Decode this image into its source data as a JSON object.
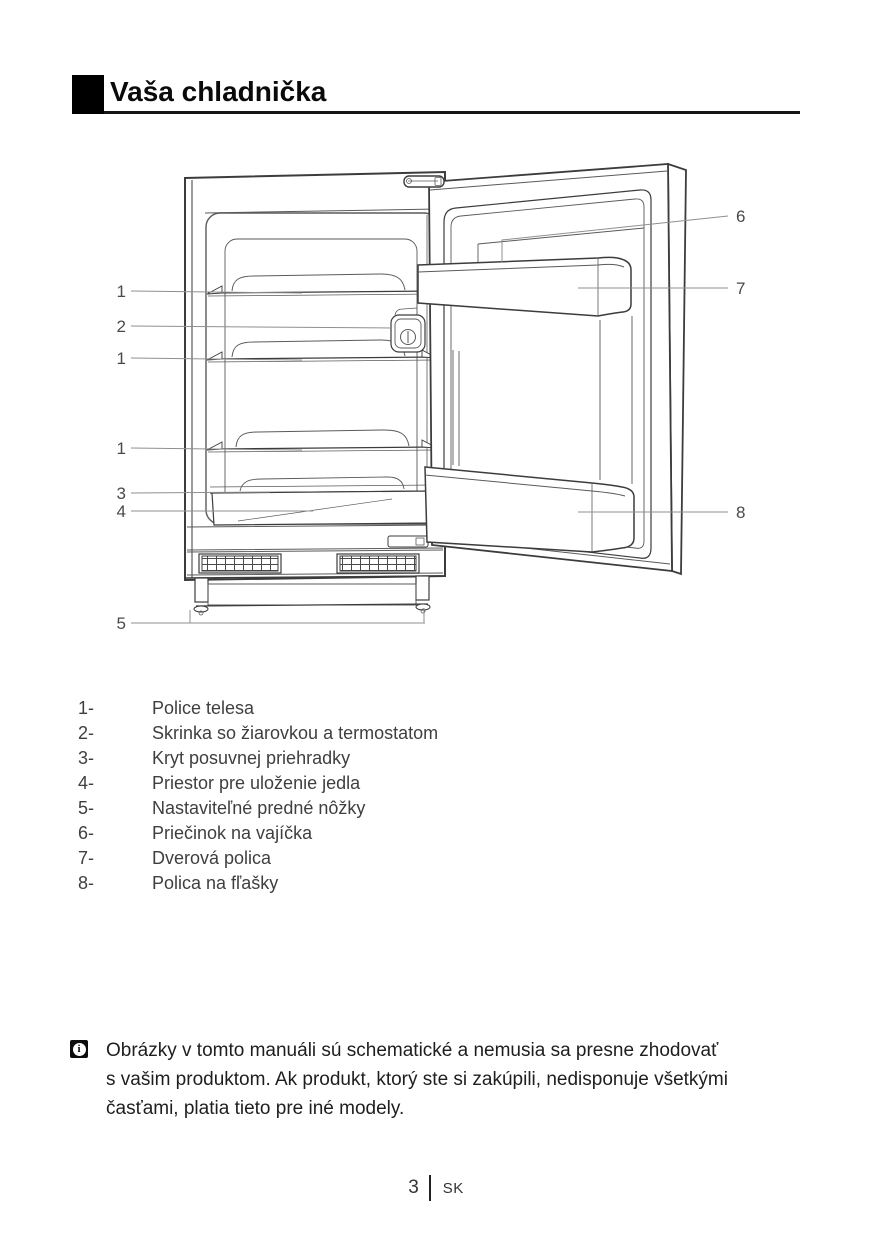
{
  "page": {
    "title": "Vaša chladnička",
    "page_number": "3",
    "language_code": "SK"
  },
  "diagram": {
    "description": "open refrigerator line drawing with numbered callouts",
    "callouts_left": [
      {
        "label": "1"
      },
      {
        "label": "2"
      },
      {
        "label": "1"
      },
      {
        "label": "1"
      },
      {
        "label": "3"
      },
      {
        "label": "4"
      },
      {
        "label": "5"
      }
    ],
    "callouts_right": [
      {
        "label": "6"
      },
      {
        "label": "7"
      },
      {
        "label": "8"
      }
    ]
  },
  "parts": {
    "items": [
      {
        "num": "1-",
        "name": "Police telesa"
      },
      {
        "num": "2-",
        "name": "Skrinka so žiarovkou a termostatom"
      },
      {
        "num": "3-",
        "name": "Kryt posuvnej priehradky"
      },
      {
        "num": "4-",
        "name": "Priestor pre uloženie jedla"
      },
      {
        "num": "5-",
        "name": "Nastaviteľné predné nôžky"
      },
      {
        "num": "6-",
        "name": "Priečinok na vajíčka"
      },
      {
        "num": "7-",
        "name": "Dverová polica"
      },
      {
        "num": "8-",
        "name": "Polica na fľašky"
      }
    ]
  },
  "note": {
    "icon": "info-icon",
    "icon_glyph": "i",
    "lines": [
      "Obrázky v tomto manuáli sú schematické a nemusia sa presne zhodovať",
      "s vašim produktom. Ak produkt, ktorý ste si zakúpili, nedisponuje všetkými",
      "časťami, platia tieto pre iné modely."
    ]
  }
}
